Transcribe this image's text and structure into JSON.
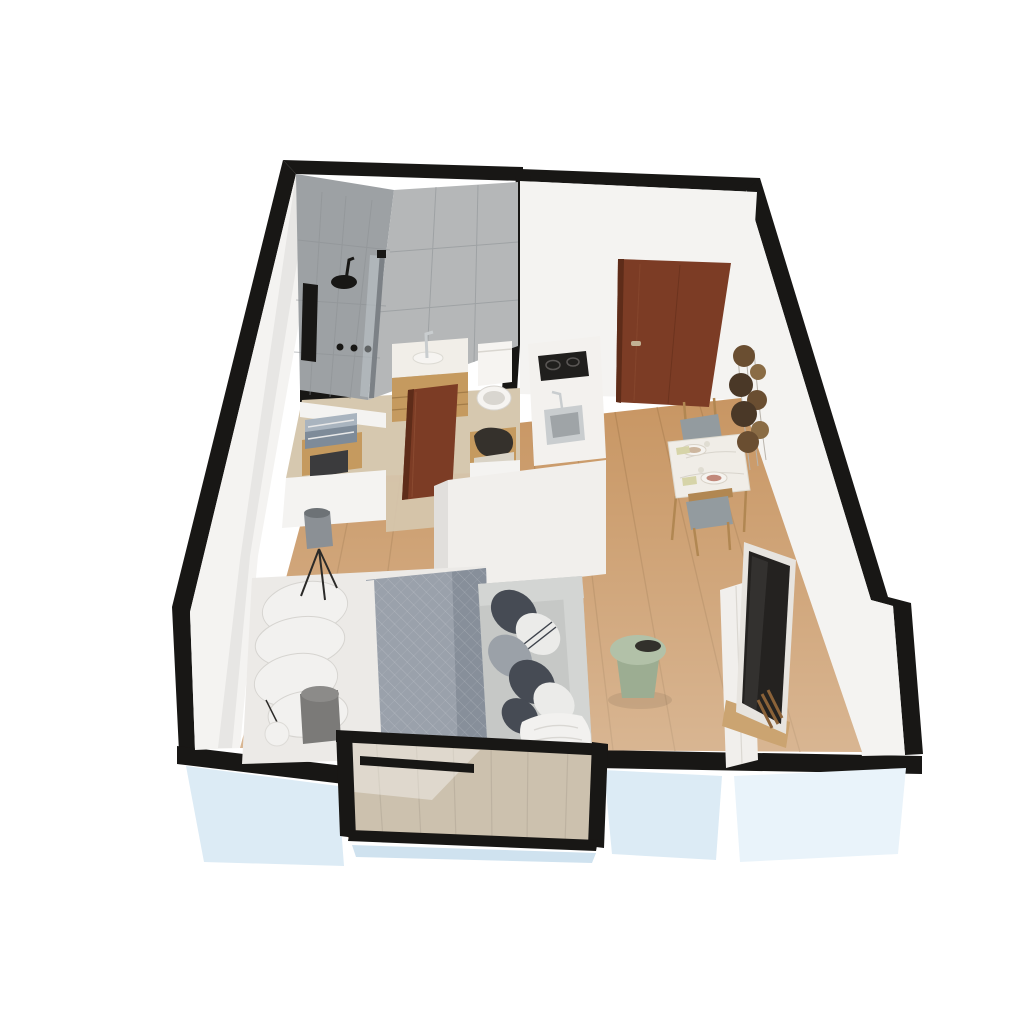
{
  "meta": {
    "type": "3d-floor-plan",
    "description": "Isometric 3D cutaway rendering of a studio apartment floor plan",
    "background": "#ffffff"
  },
  "rooms": [
    {
      "id": "bathroom",
      "objects": [
        "walk-in-shower",
        "rain-shower-head",
        "shower-niche",
        "shower-controls",
        "glass-partition",
        "vanity-sink",
        "toilet",
        "towel-alcove"
      ]
    },
    {
      "id": "entry-hall",
      "objects": [
        "entry-door",
        "closet-alcove",
        "open-bathroom-door"
      ]
    },
    {
      "id": "kitchen",
      "objects": [
        "counter",
        "induction-cooktop",
        "kitchen-sink",
        "tall-cabinet-block"
      ]
    },
    {
      "id": "living-sleeping-area",
      "objects": [
        "double-bed",
        "pillows",
        "floor-lamp",
        "sphere-lamp",
        "side-stool",
        "sofa",
        "green-side-table",
        "tv",
        "media-console"
      ]
    },
    {
      "id": "dining-area",
      "objects": [
        "dining-table",
        "dining-chairs",
        "wall-plate-decor"
      ]
    },
    {
      "id": "balcony",
      "objects": [
        "glass-balustrade",
        "balcony-floor"
      ]
    }
  ],
  "palette": {
    "wall_black": "#181715",
    "wall_white": "#f4f3f1",
    "wall_white_shade": "#e7e6e4",
    "exterior_blue": "#dcebf5",
    "exterior_blue_light": "#e9f3fa",
    "floor_wood": "#c89663",
    "floor_wood_plank": "#a5794a",
    "bathroom_floor": "#d6c8af",
    "tile_dark": "#9da1a4",
    "tile_light": "#b5b7b8",
    "tile_grout": "#8d9194",
    "glass_edge": "#7c8186",
    "glass_fill": "rgba(205,215,220,0.40)",
    "door_brown": "#7c3c25",
    "door_brown_dark": "#5e2c19",
    "door_handle": "#c2b193",
    "vanity_wood": "#c59a5f",
    "vanity_counter": "#f1eee8",
    "fixture_white": "#f6f4f1",
    "fixture_shadow": "#d9d6d0",
    "steel": "#c9cdcf",
    "steel_dark": "#9fa4a7",
    "cooktop_black": "#201f1d",
    "burner_ring": "#5a5755",
    "counter_white": "#f3f1ee",
    "block_white": "#f1efec",
    "block_shade": "#e1dfdc",
    "pillow_white": "#f2f1ef",
    "pillow_shadow": "#d6d4d0",
    "sheet_white": "#eceae7",
    "duvet_gray": "#9aa1ab",
    "duvet_gray_dark": "#878f9a",
    "sofa_gray": "#c6c8c6",
    "sofa_gray_light": "#d3d5d3",
    "cushion_dark": "#464b54",
    "cushion_mid": "#9ba1a8",
    "cushion_white": "#ebebe9",
    "table_green": "#b2c1a8",
    "table_green_dark": "#9cad92",
    "tray_black": "#32302b",
    "tv_frame": "#e7e4df",
    "tv_screen": "#242220",
    "wood_accent": "#cba471",
    "firewood": "#8b6238",
    "dining_table": "#f0ede7",
    "chair_wood": "#b18752",
    "chair_cushion": "#939b9f",
    "plate_white": "#f5f3ef",
    "plate_accent": "#c2897b",
    "plate_accent2": "#cdb69e",
    "napkin": "#d6d4a8",
    "decor_dark": "#4a3827",
    "decor_mid": "#6a4e31",
    "decor_light": "#8a6c45",
    "decor_wire": "#b9b4ac",
    "towel_blue": "#7e8b99",
    "towel_blue_light": "#a9b4bf",
    "towel_dark": "#3b3b3d",
    "bag_dark": "#35312c",
    "lamp_gray": "#8b9095",
    "lamp_gray_dark": "#6d7276",
    "leg_black": "#2b2a28",
    "balcony_wood": "#d3bc9c",
    "balcony_plank": "#b9a386",
    "glass_tint": "rgba(188,204,214,0.30)",
    "sheen_white": "rgba(255,255,255,0.38)",
    "shadow_soft": "rgba(0,0,0,0.08)",
    "sill_blue": "#cfe2ef"
  }
}
